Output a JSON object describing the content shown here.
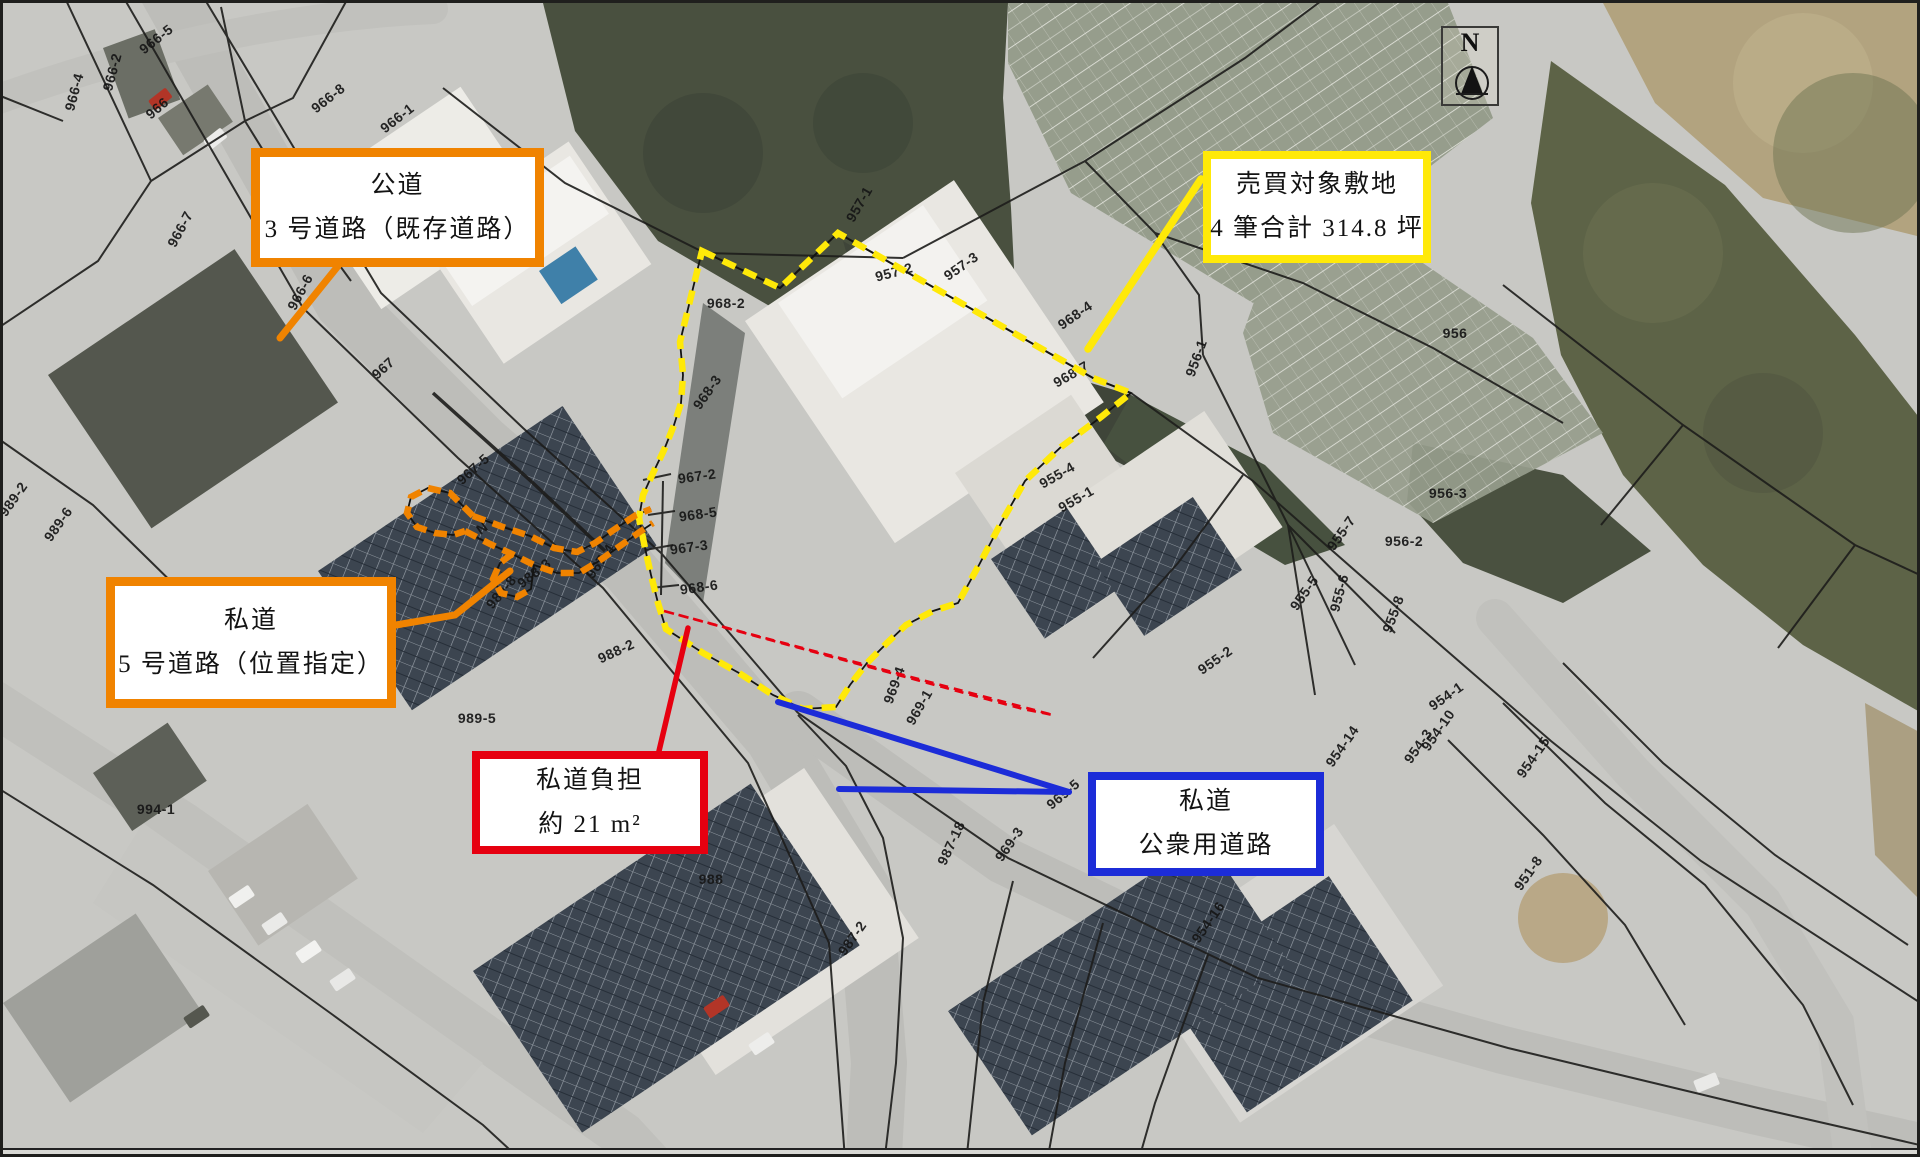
{
  "annotation_boxes": [
    {
      "name": "public-road",
      "lines": [
        "公道",
        "3 号道路（既存道路）"
      ],
      "border": "#f08300",
      "x": 248,
      "y": 145,
      "w": 293,
      "h": 119,
      "bw": 9
    },
    {
      "name": "sale-site",
      "lines": [
        "売買対象敷地",
        "4 筆合計 314.8 坪"
      ],
      "border": "#ffe908",
      "x": 1200,
      "y": 148,
      "w": 228,
      "h": 112,
      "bw": 8
    },
    {
      "name": "private-road-5",
      "lines": [
        "私道",
        "5 号道路（位置指定）"
      ],
      "border": "#f08300",
      "x": 103,
      "y": 574,
      "w": 290,
      "h": 131,
      "bw": 9
    },
    {
      "name": "private-road-burden",
      "lines": [
        "私道負担",
        "約 21 m²"
      ],
      "border": "#e60010",
      "x": 469,
      "y": 748,
      "w": 236,
      "h": 103,
      "bw": 8
    },
    {
      "name": "private-public-road",
      "lines": [
        "私道",
        "公衆用道路"
      ],
      "border": "#1c2cd8",
      "x": 1085,
      "y": 769,
      "w": 236,
      "h": 104,
      "bw": 8
    }
  ],
  "north": {
    "label": "N"
  },
  "colors": {
    "yellow": "#ffe908",
    "orange": "#f08300",
    "red": "#e60010",
    "blue": "#1c2cd8",
    "line": "#141412"
  },
  "parcel_labels": [
    {
      "t": "966-5",
      "x": 153,
      "y": 36,
      "r": -38
    },
    {
      "t": "966-2",
      "x": 109,
      "y": 69,
      "r": -75
    },
    {
      "t": "966-4",
      "x": 71,
      "y": 89,
      "r": -75
    },
    {
      "t": "966",
      "x": 154,
      "y": 105,
      "r": -40
    },
    {
      "t": "966-8",
      "x": 325,
      "y": 95,
      "r": -38
    },
    {
      "t": "966-1",
      "x": 394,
      "y": 115,
      "r": -38
    },
    {
      "t": "966-7",
      "x": 177,
      "y": 226,
      "r": -62
    },
    {
      "t": "966-6",
      "x": 297,
      "y": 289,
      "r": -62
    },
    {
      "t": "967",
      "x": 380,
      "y": 365,
      "r": -42
    },
    {
      "t": "967-5",
      "x": 470,
      "y": 466,
      "r": -42
    },
    {
      "t": "N",
      "x": 479,
      "y": 525,
      "r": -35
    },
    {
      "t": "988-3",
      "x": 531,
      "y": 570,
      "r": -38
    },
    {
      "t": "989-8",
      "x": 498,
      "y": 589,
      "r": -50
    },
    {
      "t": "967-4",
      "x": 597,
      "y": 558,
      "r": -55
    },
    {
      "t": "967-2",
      "x": 694,
      "y": 473,
      "r": -8
    },
    {
      "t": "968-5",
      "x": 695,
      "y": 511,
      "r": -8
    },
    {
      "t": "967-3",
      "x": 686,
      "y": 544,
      "r": -8
    },
    {
      "t": "968-6",
      "x": 696,
      "y": 584,
      "r": -8
    },
    {
      "t": "968-2",
      "x": 723,
      "y": 300,
      "r": 0
    },
    {
      "t": "968-3",
      "x": 704,
      "y": 389,
      "r": -55
    },
    {
      "t": "957-1",
      "x": 856,
      "y": 201,
      "r": -60
    },
    {
      "t": "957-2",
      "x": 891,
      "y": 269,
      "r": -15
    },
    {
      "t": "957-3",
      "x": 958,
      "y": 263,
      "r": -35
    },
    {
      "t": "968-4",
      "x": 1072,
      "y": 312,
      "r": -35
    },
    {
      "t": "968-7",
      "x": 1068,
      "y": 371,
      "r": -30
    },
    {
      "t": "956",
      "x": 1452,
      "y": 330,
      "r": 0
    },
    {
      "t": "956-1",
      "x": 1193,
      "y": 355,
      "r": -70
    },
    {
      "t": "956-3",
      "x": 1445,
      "y": 490,
      "r": 0
    },
    {
      "t": "956-2",
      "x": 1401,
      "y": 538,
      "r": 0
    },
    {
      "t": "955-7",
      "x": 1338,
      "y": 530,
      "r": -55
    },
    {
      "t": "955-6",
      "x": 1336,
      "y": 590,
      "r": -75
    },
    {
      "t": "955-5",
      "x": 1301,
      "y": 590,
      "r": -55
    },
    {
      "t": "955-8",
      "x": 1390,
      "y": 611,
      "r": -70
    },
    {
      "t": "955-4",
      "x": 1054,
      "y": 472,
      "r": -30
    },
    {
      "t": "955-1",
      "x": 1073,
      "y": 496,
      "r": -30
    },
    {
      "t": "955-2",
      "x": 1212,
      "y": 657,
      "r": -35
    },
    {
      "t": "954-1",
      "x": 1443,
      "y": 693,
      "r": -35
    },
    {
      "t": "954-10",
      "x": 1435,
      "y": 727,
      "r": -55
    },
    {
      "t": "954-3",
      "x": 1415,
      "y": 743,
      "r": -55
    },
    {
      "t": "954-14",
      "x": 1339,
      "y": 743,
      "r": -55
    },
    {
      "t": "954-15",
      "x": 1530,
      "y": 754,
      "r": -55
    },
    {
      "t": "951-8",
      "x": 1525,
      "y": 870,
      "r": -55
    },
    {
      "t": "954-16",
      "x": 1205,
      "y": 919,
      "r": -55
    },
    {
      "t": "969-4",
      "x": 891,
      "y": 682,
      "r": -70
    },
    {
      "t": "969-1",
      "x": 916,
      "y": 704,
      "r": -60
    },
    {
      "t": "969-5",
      "x": 1060,
      "y": 791,
      "r": -40
    },
    {
      "t": "969-3",
      "x": 1006,
      "y": 841,
      "r": -55
    },
    {
      "t": "987-18",
      "x": 948,
      "y": 840,
      "r": -65
    },
    {
      "t": "987-2",
      "x": 849,
      "y": 935,
      "r": -55
    },
    {
      "t": "988",
      "x": 708,
      "y": 876,
      "r": 0
    },
    {
      "t": "988-2",
      "x": 613,
      "y": 648,
      "r": -25
    },
    {
      "t": "989-5",
      "x": 474,
      "y": 715,
      "r": 0
    },
    {
      "t": "989-2",
      "x": 10,
      "y": 496,
      "r": -55
    },
    {
      "t": "989-6",
      "x": 55,
      "y": 521,
      "r": -55
    },
    {
      "t": "994-1",
      "x": 153,
      "y": 806,
      "r": 0
    }
  ]
}
